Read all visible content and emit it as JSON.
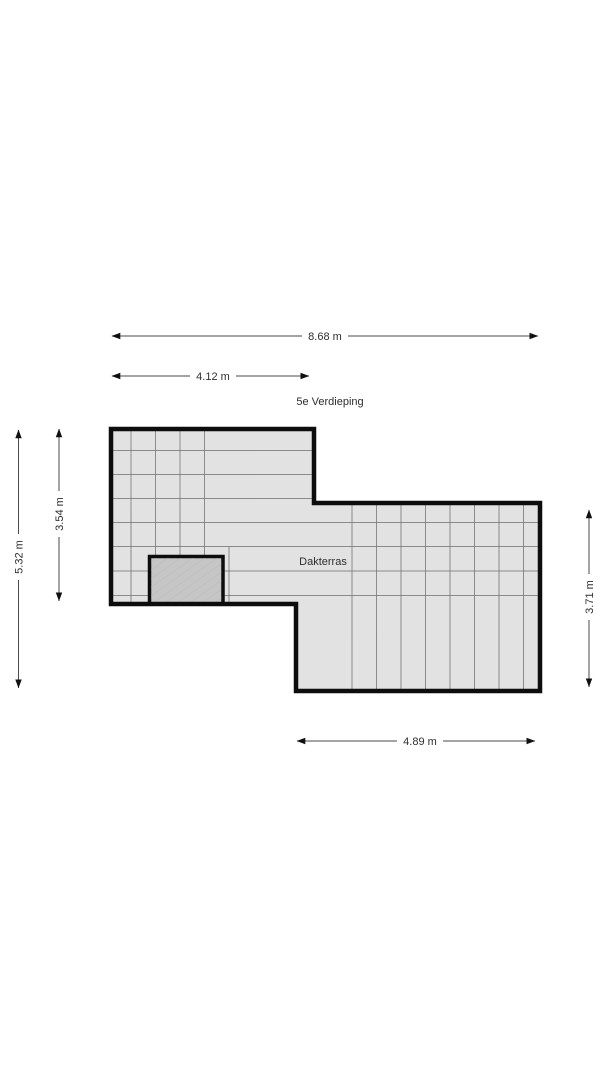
{
  "floorplan": {
    "title": "5e Verdieping",
    "room_label": "Dakterras",
    "dimensions": {
      "top_total": "8.68 m",
      "top_left_section": "4.12 m",
      "left_total": "5.32 m",
      "left_section": "3.54 m",
      "right_section": "3.71 m",
      "bottom_section": "4.89 m"
    },
    "colors": {
      "background": "#ffffff",
      "floor_fill": "#e2e2e2",
      "wall": "#0d0d0d",
      "grid_line": "#6f6f6f",
      "structure_fill": "#c6c6c6",
      "dimension_line": "#4a4a4a",
      "text": "#2e2e2e"
    }
  }
}
